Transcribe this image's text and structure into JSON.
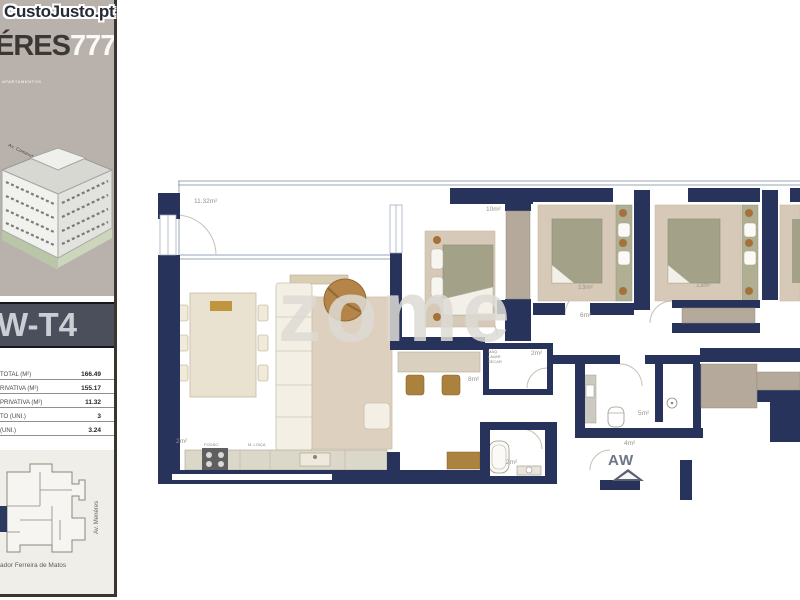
{
  "site_logo": "CustoJusto.pt",
  "sidebar": {
    "brand": {
      "name_dark": "ÉRES",
      "name_accent": "777",
      "tagline": "APARTAMENTOS"
    },
    "building_street_label": "Av. Comendador Ferreira de Matos",
    "unit_banner": "W-T4",
    "areas_table": {
      "rows": [
        {
          "label": "TOTAL (M²)",
          "value": "166.49"
        },
        {
          "label": "RIVATIVA (M²)",
          "value": "155.17"
        },
        {
          "label": "PRIVATIVA (M²)",
          "value": "11.32"
        },
        {
          "label": "TO (UNI.)",
          "value": "3"
        },
        {
          "label": "(UNI.)",
          "value": "3.24"
        }
      ]
    },
    "siteplan": {
      "street_vertical": "Av. Menéres",
      "street_bottom": "ador Ferreira de Matos"
    }
  },
  "plan": {
    "watermark": "zome",
    "unit_code": "AW",
    "labels": [
      {
        "text": "11.32m²",
        "x": 44,
        "y": 38
      },
      {
        "text": "10m²",
        "x": 336,
        "y": 46
      },
      {
        "text": "13m²",
        "x": 428,
        "y": 124
      },
      {
        "text": "13m²",
        "x": 546,
        "y": 122
      },
      {
        "text": "6m²",
        "x": 430,
        "y": 152
      },
      {
        "text": "2m²",
        "x": 381,
        "y": 190
      },
      {
        "text": "8m²",
        "x": 318,
        "y": 216
      },
      {
        "text": "2m²",
        "x": 26,
        "y": 278
      },
      {
        "text": "2m²",
        "x": 356,
        "y": 299
      },
      {
        "text": "5m²",
        "x": 488,
        "y": 250
      },
      {
        "text": "4m²",
        "x": 474,
        "y": 280
      }
    ],
    "kitchen_labels": [
      {
        "text": "FOGÃO",
        "x": 54,
        "y": 281
      },
      {
        "text": "M. LOIÇA",
        "x": 98,
        "y": 281
      }
    ],
    "laundry_lines": [
      "MÁQ.",
      "LAVAR",
      "SECAR"
    ],
    "colors": {
      "wall": "#28335c",
      "wood": "#b08345",
      "bed": "#a3a289",
      "rug": "#d6c9b7",
      "wardrobe": "#b4a99b"
    }
  }
}
